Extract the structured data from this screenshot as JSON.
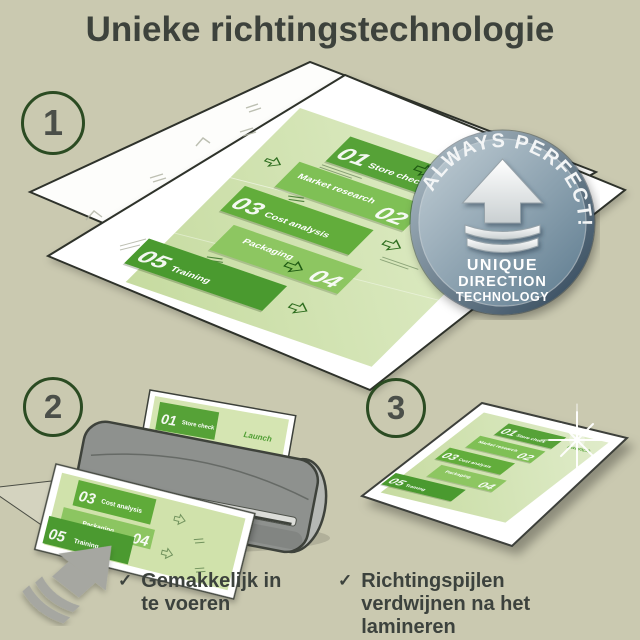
{
  "title": "Unieke richtingstechnologie",
  "steps": [
    {
      "number": "1"
    },
    {
      "number": "2"
    },
    {
      "number": "3"
    }
  ],
  "badge": {
    "arc_text": "ALWAYS PERFECT!",
    "line1": "UNIQUE",
    "line2": "DIRECTION",
    "line3": "TECHNOLOGY"
  },
  "doc": {
    "launch": "Launch",
    "items": [
      {
        "num": "01",
        "label": "Store check"
      },
      {
        "num": "02",
        "label": "Market research"
      },
      {
        "num": "03",
        "label": "Cost analysis"
      },
      {
        "num": "04",
        "label": "Packaging"
      },
      {
        "num": "05",
        "label": "Training"
      }
    ]
  },
  "notes": [
    {
      "check": "✓",
      "text": "Gemakkelijk in te voeren"
    },
    {
      "check": "✓",
      "text": "Richtingspijlen verdwijnen na het lamineren"
    }
  ],
  "colors": {
    "background": "#cac9b0",
    "title_text": "#3d423c",
    "circle_green": "#2b4b22",
    "accent_green_dark": "#4a9a2f",
    "accent_green": "#56a237",
    "accent_green_light": "#8dc661",
    "doc_background": "#cfe2ac",
    "badge_steel": "#5f7b8e",
    "machine_gray": "#8e918e",
    "arrow_gray": "#a6a7a1"
  }
}
